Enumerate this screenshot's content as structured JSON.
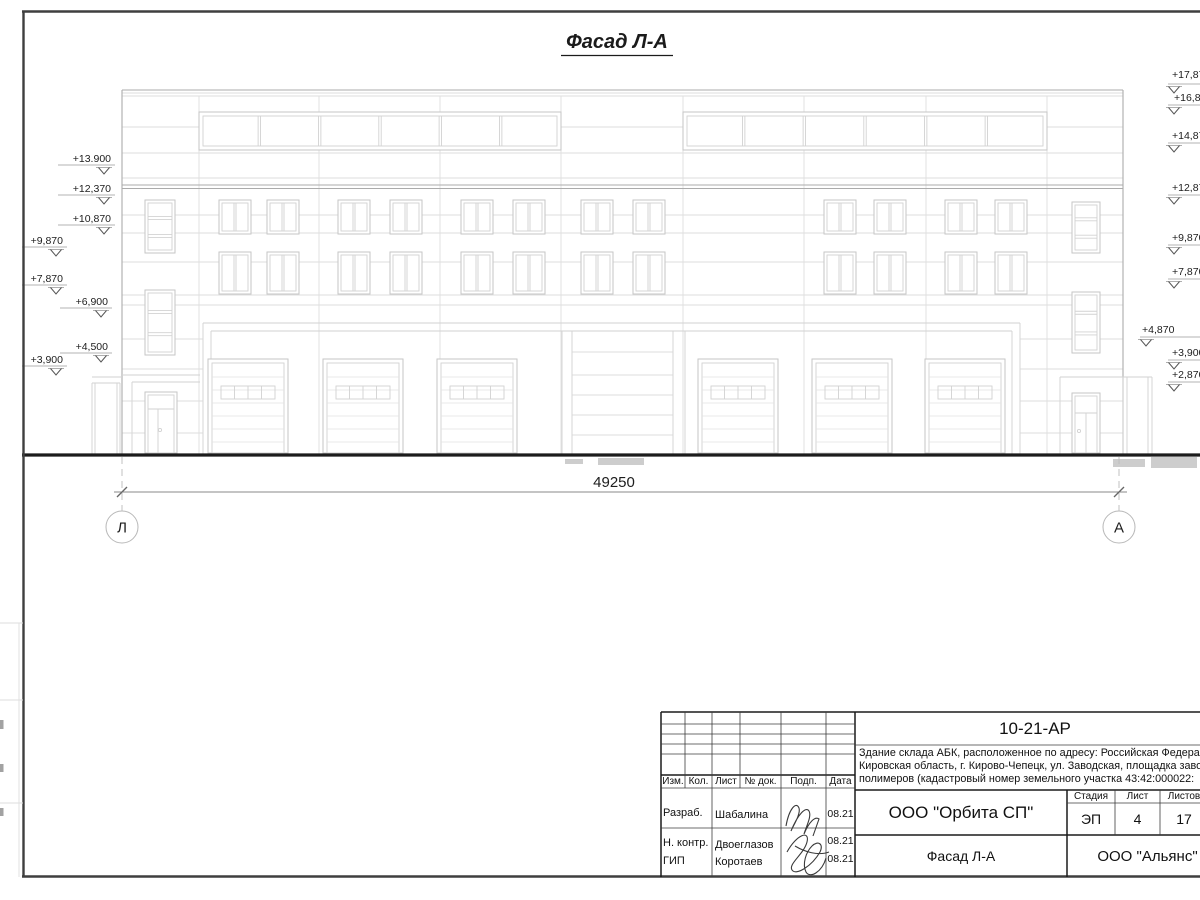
{
  "drawing": {
    "title": "Фасад Л-А",
    "dimension_total": "49250",
    "axis_left": "Л",
    "axis_right": "А",
    "elevation_marks_left": [
      {
        "label": "+13.900",
        "rx": 111,
        "ty": 162,
        "uy": 165,
        "lx": 58,
        "ax": 104,
        "ay": 174
      },
      {
        "label": "+12,370",
        "rx": 111,
        "ty": 192,
        "uy": 195,
        "lx": 58,
        "ax": 104,
        "ay": 204
      },
      {
        "label": "+10,870",
        "rx": 111,
        "ty": 222,
        "uy": 225,
        "lx": 58,
        "ax": 104,
        "ay": 234
      },
      {
        "label": "+9,870",
        "rx": 63,
        "ty": 244,
        "uy": 247,
        "lx": 22,
        "ax": 56,
        "ay": 256
      },
      {
        "label": "+7,870",
        "rx": 63,
        "ty": 282,
        "uy": 285,
        "lx": 22,
        "ax": 56,
        "ay": 294
      },
      {
        "label": "+6,900",
        "rx": 108,
        "ty": 305,
        "uy": 308,
        "lx": 60,
        "ax": 101,
        "ay": 317
      },
      {
        "label": "+4,500",
        "rx": 108,
        "ty": 350,
        "uy": 353,
        "lx": 60,
        "ax": 101,
        "ay": 362
      },
      {
        "label": "+3,900",
        "rx": 63,
        "ty": 363,
        "uy": 366,
        "lx": 22,
        "ax": 56,
        "ay": 375
      }
    ],
    "elevation_marks_right": [
      {
        "label": "+17,870",
        "tx": 1172,
        "ty": 78,
        "uy": 84,
        "ax": 1174,
        "ay": 93
      },
      {
        "label": "+16,870",
        "tx": 1174,
        "ty": 101,
        "uy": 105,
        "ax": 1174,
        "ay": 114
      },
      {
        "label": "+14,870",
        "tx": 1172,
        "ty": 139,
        "uy": 143,
        "ax": 1174,
        "ay": 152
      },
      {
        "label": "+12,870",
        "tx": 1172,
        "ty": 191,
        "uy": 195,
        "ax": 1174,
        "ay": 204
      },
      {
        "label": "+9,870",
        "tx": 1172,
        "ty": 241,
        "uy": 245,
        "ax": 1174,
        "ay": 254
      },
      {
        "label": "+7,870",
        "tx": 1172,
        "ty": 275,
        "uy": 279,
        "ax": 1174,
        "ay": 288
      },
      {
        "label": "+4,870",
        "tx": 1142,
        "ty": 333,
        "uy": 337,
        "ax": 1146,
        "ay": 346
      },
      {
        "label": "+3,900",
        "tx": 1172,
        "ty": 356,
        "uy": 360,
        "ax": 1174,
        "ay": 369
      },
      {
        "label": "+2,870",
        "tx": 1172,
        "ty": 378,
        "uy": 382,
        "ax": 1174,
        "ay": 391
      }
    ]
  },
  "title_block": {
    "doc_number": "10-21-АР",
    "description_lines": [
      "Здание склада АБК, расположенное по адресу: Российская Федерация,",
      "Кировская область, г. Кирово-Чепецк, ул. Заводская, площадка завода",
      "полимеров (кадастровый номер земельного участка 43:42:000022:"
    ],
    "org": "ООО \"Орбита СП\"",
    "sheet_title": "Фасад Л-А",
    "contractor": "ООО \"Альянс\"",
    "stage_label": "Стадия",
    "sheet_label": "Лист",
    "sheets_label": "Листов",
    "stage": "ЭП",
    "sheet": "4",
    "sheets": "17",
    "columns": [
      "Изм.",
      "Кол.",
      "Лист",
      "№ док.",
      "Подп.",
      "Дата"
    ],
    "rows": [
      {
        "role": "Разраб.",
        "name": "Шабалина",
        "date": "08.21"
      },
      {
        "role": "Н. контр.",
        "name": "Двоеглазов",
        "date": "08.21"
      },
      {
        "role": "ГИП",
        "name": "Коротаев",
        "date": "08.21"
      }
    ]
  },
  "colors": {
    "ink": "#1b1b1b",
    "faint_line": "#dedede",
    "medium_line": "#ababab"
  }
}
